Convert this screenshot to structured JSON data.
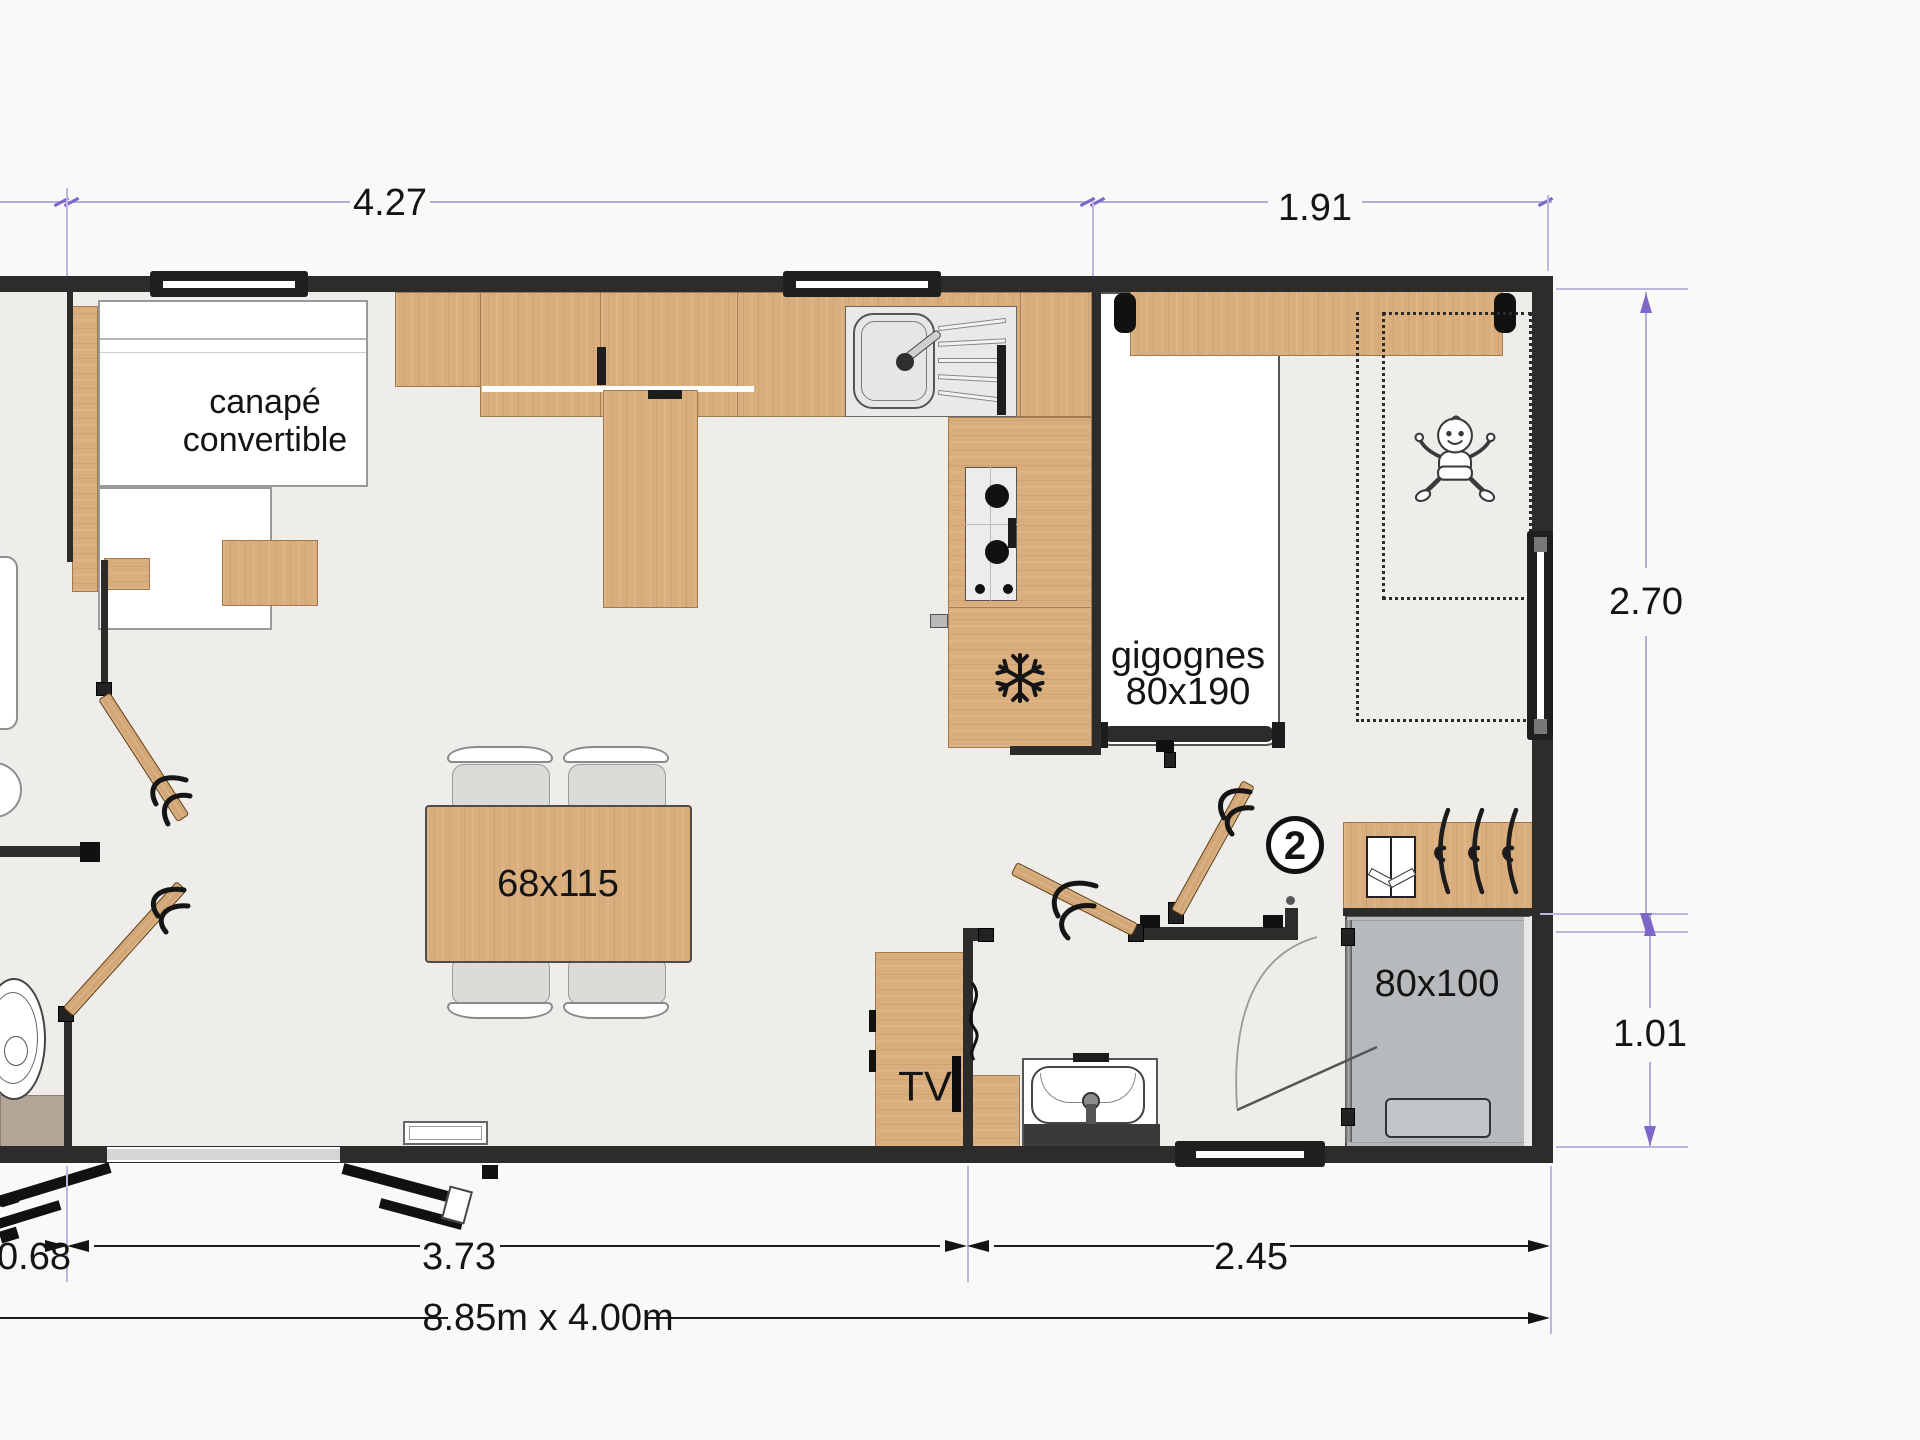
{
  "plan": {
    "labels": {
      "sofa_line1": "canapé",
      "sofa_line2": "convertible",
      "nesting_bed_line1": "gigognes",
      "nesting_bed_line2": "80x190",
      "dining_table": "68x115",
      "tv": "TV",
      "shower": "80x100",
      "bedroom_number": "2"
    },
    "dimensions": {
      "top_left": "4.27",
      "top_right": "1.91",
      "right_upper": "2.70",
      "right_lower": "1.01",
      "bottom_left": "0.68",
      "bottom_center": "3.73",
      "bottom_right": "2.45",
      "overall": "8.85m x 4.00m"
    },
    "icons": {
      "fridge": "snowflake-icon",
      "nursery": "baby-icon",
      "wardrobe": "hanger-icon",
      "wardrobe_shelf": "folded-clothes-icon"
    },
    "colors": {
      "wall": "#2e2c2b",
      "wood": "#d9ad7c",
      "floor": "#efedea",
      "exterior": "#faf9f8",
      "shower": "#b7babc",
      "toilet_cabinet": "#b3a698",
      "dimension_line": "#b4acd8",
      "dimension_arrow": "#7b68c8",
      "text": "#141414"
    }
  }
}
